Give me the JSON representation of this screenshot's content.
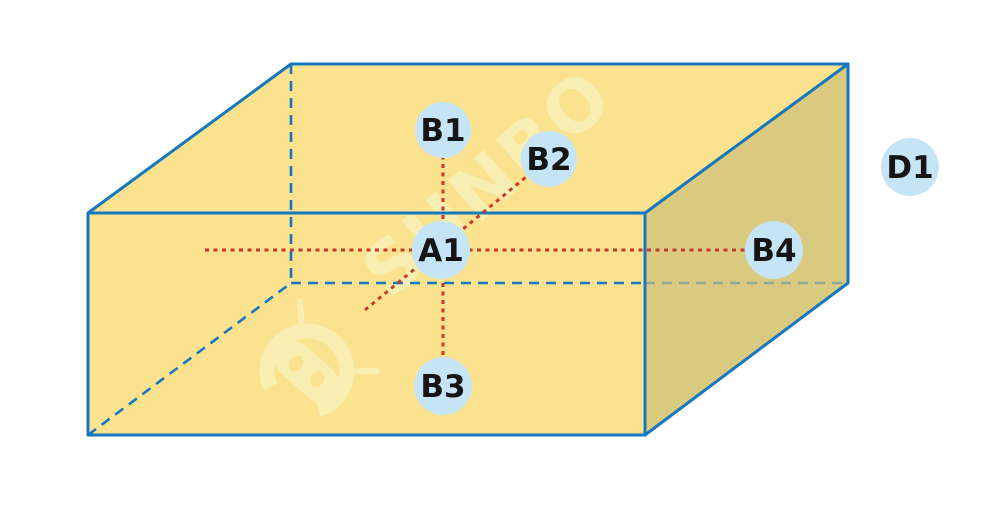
{
  "diagram": {
    "title": "box-measurement-points-diagram",
    "watermark_text": "SUNBO",
    "points": {
      "A1": {
        "label": "A1"
      },
      "B1": {
        "label": "B1"
      },
      "B2": {
        "label": "B2"
      },
      "B3": {
        "label": "B3"
      },
      "B4": {
        "label": "B4"
      },
      "D1": {
        "label": "D1"
      }
    }
  },
  "colors": {
    "canvas": "#ffffff",
    "face-light": "#fae28e",
    "face-dark": "#d9ca80",
    "edge-blue": "#1577be",
    "line-red": "#c33a2e",
    "point-fill": "#c5e4f5",
    "label-text": "#151515",
    "watermark-tint": "#f8eeb2"
  }
}
